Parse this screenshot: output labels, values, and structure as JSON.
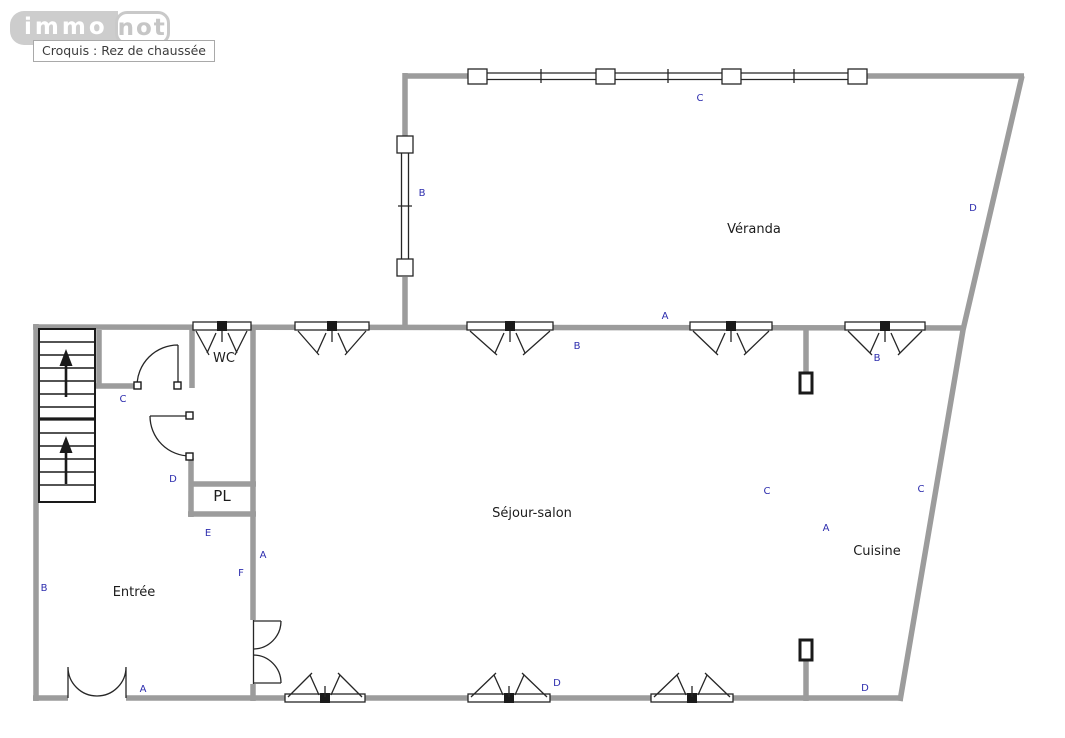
{
  "header": {
    "logo_part1": "immo",
    "logo_part2": "not",
    "caption": "Croquis : Rez de chaussée"
  },
  "rooms": {
    "veranda": "Véranda",
    "wc": "WC",
    "pl": "PL",
    "sejour": "Séjour-salon",
    "cuisine": "Cuisine",
    "entree": "Entrée"
  },
  "letters": {
    "bay_top": "C",
    "veranda_left": "B",
    "right_wall_upper": "D",
    "sejour_north_wall": "A",
    "sejour_window_left": "B",
    "sejour_window_right": "B",
    "stair_niche": "C",
    "hall_door": "D",
    "sejour_east": "C",
    "cuisine_west_wall": "C",
    "cuisine": "A",
    "pl_wall": "E",
    "sejour_west_wall": "A",
    "entree_wall": "F",
    "left_wall": "B",
    "bottom_window_center": "D",
    "entrance_door": "A",
    "bottom_right": "D"
  },
  "colors": {
    "wall": "#9c9c9c",
    "line": "#262626",
    "letter": "#2d2dae",
    "label": "#1c1c1c",
    "logo": "#c9c9c9"
  }
}
